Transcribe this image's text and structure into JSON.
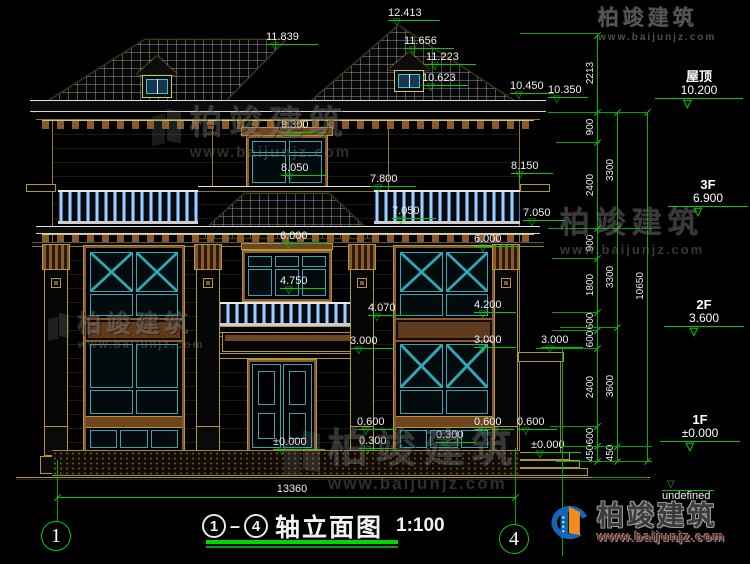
{
  "meta": {
    "background": "#000000",
    "annotation_color": "#00cc00",
    "text_color": "#f2f2f2"
  },
  "title_block": {
    "axis_from": "1",
    "axis_to": "4",
    "separator": "—",
    "title": "轴立面图",
    "scale": "1:100",
    "overall_dim": "13360"
  },
  "axis_bubbles": [
    {
      "n": "1",
      "x": 41,
      "y": 521
    },
    {
      "n": "4",
      "x": 499,
      "y": 524
    }
  ],
  "floor_markers": [
    {
      "label": "屋顶",
      "value": "10.200",
      "x": 655,
      "y": 70,
      "lw": 88
    },
    {
      "label": "3F",
      "value": "6.900",
      "x": 668,
      "y": 178,
      "lw": 80
    },
    {
      "label": "2F",
      "value": "3.600",
      "x": 664,
      "y": 298,
      "lw": 80
    },
    {
      "label": "1F",
      "value": "±0.000",
      "x": 660,
      "y": 413,
      "lw": 80
    }
  ],
  "ground_marker": {
    "value": "-0.450",
    "x": 662,
    "y": 489,
    "w": 52
  },
  "level_markers": [
    {
      "v": "12.413",
      "x": 388,
      "y": 8,
      "w": 52
    },
    {
      "v": "11.839",
      "x": 266,
      "y": 32,
      "w": 52
    },
    {
      "v": "11.656",
      "x": 404,
      "y": 36,
      "w": 50
    },
    {
      "v": "11.223",
      "x": 426,
      "y": 52,
      "w": 50
    },
    {
      "v": "10.623",
      "x": 422,
      "y": 73,
      "w": 46
    },
    {
      "v": "10.450",
      "x": 510,
      "y": 81,
      "w": 44
    },
    {
      "v": "10.350",
      "x": 548,
      "y": 85,
      "w": 40
    },
    {
      "v": "9.300",
      "x": 281,
      "y": 120,
      "w": 46
    },
    {
      "v": "8.050",
      "x": 281,
      "y": 163,
      "w": 46
    },
    {
      "v": "8.150",
      "x": 511,
      "y": 161,
      "w": 42
    },
    {
      "v": "7.800",
      "x": 370,
      "y": 174,
      "w": 46
    },
    {
      "v": "7.050",
      "x": 392,
      "y": 206,
      "w": 44
    },
    {
      "v": "7.050",
      "x": 523,
      "y": 208,
      "w": 42
    },
    {
      "v": "6.000",
      "x": 280,
      "y": 231,
      "w": 46
    },
    {
      "v": "6.000",
      "x": 474,
      "y": 234,
      "w": 44
    },
    {
      "v": "4.750",
      "x": 280,
      "y": 276,
      "w": 46
    },
    {
      "v": "4.070",
      "x": 368,
      "y": 303,
      "w": 44
    },
    {
      "v": "4.200",
      "x": 474,
      "y": 300,
      "w": 42
    },
    {
      "v": "3.000",
      "x": 350,
      "y": 336,
      "w": 44
    },
    {
      "v": "3.000",
      "x": 474,
      "y": 335,
      "w": 42
    },
    {
      "v": "3.000",
      "x": 541,
      "y": 335,
      "w": 42
    },
    {
      "v": "0.600",
      "x": 357,
      "y": 417,
      "w": 40
    },
    {
      "v": "0.300",
      "x": 359,
      "y": 436,
      "w": 38
    },
    {
      "v": "0.300",
      "x": 436,
      "y": 430,
      "w": 40
    },
    {
      "v": "0.600",
      "x": 474,
      "y": 417,
      "w": 40
    },
    {
      "v": "0.600",
      "x": 517,
      "y": 417,
      "w": 40
    },
    {
      "v": "±0.000",
      "x": 273,
      "y": 437,
      "w": 52
    },
    {
      "v": "±0.000",
      "x": 531,
      "y": 440,
      "w": 50
    }
  ],
  "dim_columns": [
    {
      "x": 597,
      "top": 35,
      "bot": 461,
      "ticks": [
        35,
        112,
        142,
        228,
        258,
        312,
        330,
        348,
        426,
        446,
        461
      ],
      "labels": [
        [
          "2213",
          73
        ],
        [
          "900",
          127
        ],
        [
          "2400",
          185
        ],
        [
          "900",
          243
        ],
        [
          "1800",
          285
        ],
        [
          "600",
          321
        ],
        [
          "600",
          339
        ],
        [
          "2400",
          387
        ],
        [
          "600",
          436
        ],
        [
          "450",
          453
        ]
      ]
    },
    {
      "x": 617,
      "top": 112,
      "bot": 461,
      "ticks": [
        112,
        228,
        327,
        446,
        461
      ],
      "labels": [
        [
          "3300",
          170
        ],
        [
          "3300",
          277
        ],
        [
          "3600",
          386
        ],
        [
          "450",
          453
        ]
      ]
    },
    {
      "x": 647,
      "top": 112,
      "bot": 461,
      "ticks": [
        112,
        461
      ],
      "labels": [
        [
          "10650",
          286
        ]
      ]
    }
  ],
  "aux_lines_h": [
    [
      520,
      33,
      78
    ],
    [
      548,
      112,
      100
    ],
    [
      556,
      142,
      44
    ],
    [
      548,
      228,
      104
    ],
    [
      552,
      258,
      46
    ],
    [
      552,
      312,
      46
    ],
    [
      552,
      330,
      46
    ],
    [
      560,
      327,
      58
    ],
    [
      536,
      348,
      62
    ],
    [
      550,
      426,
      48
    ],
    [
      560,
      446,
      92
    ],
    [
      556,
      461,
      96
    ],
    [
      592,
      477,
      56
    ]
  ],
  "aux_lines_v": [
    [
      562,
      348,
      208
    ],
    [
      57,
      460,
      61
    ],
    [
      515,
      448,
      76
    ]
  ],
  "watermark": {
    "brand": "柏竣建筑",
    "url": "www.baijunjz.com",
    "instances": [
      {
        "x": 598,
        "y": 2,
        "big": 21,
        "small": 10,
        "op": 0.7,
        "ico": false
      },
      {
        "x": 152,
        "y": 96,
        "big": 33,
        "small": 15,
        "op": 0.42,
        "ico": true
      },
      {
        "x": 560,
        "y": 198,
        "big": 30,
        "small": 13,
        "op": 0.48,
        "ico": false
      },
      {
        "x": 48,
        "y": 304,
        "big": 24,
        "small": 11,
        "op": 0.45,
        "ico": true
      },
      {
        "x": 284,
        "y": 416,
        "big": 40,
        "small": 17,
        "op": 0.42,
        "ico": true
      }
    ]
  },
  "logo": {
    "brand": "柏竣建筑",
    "url": "www.baijunjz.com"
  }
}
